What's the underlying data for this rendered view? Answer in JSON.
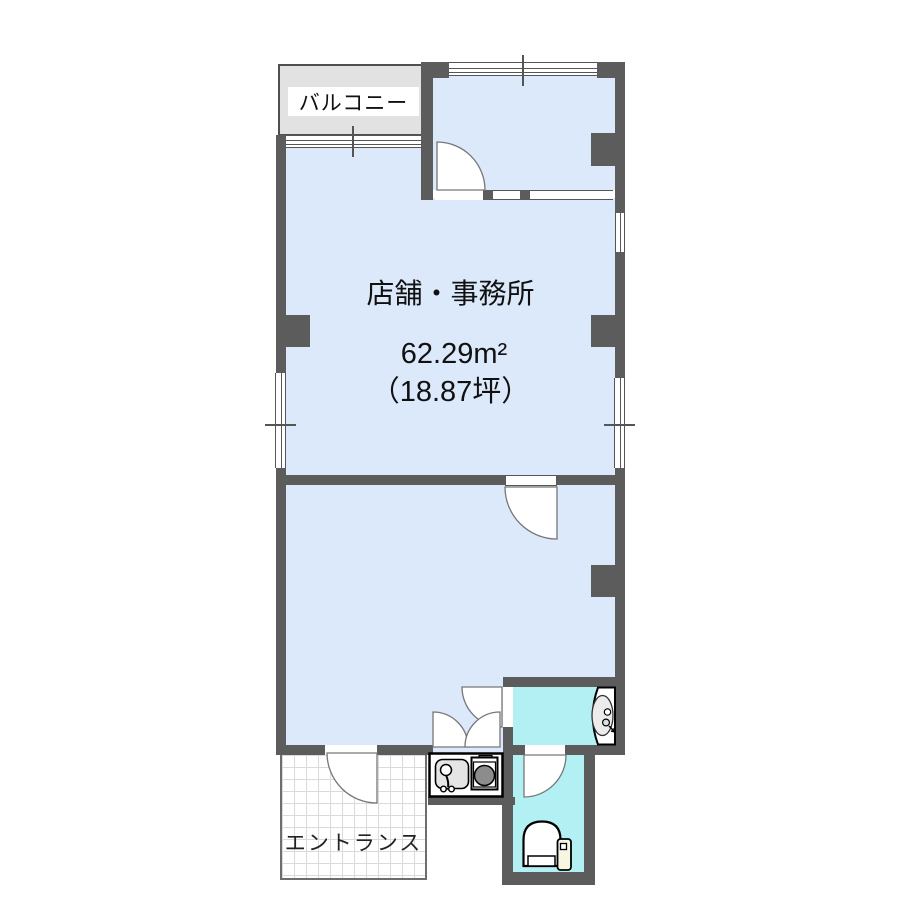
{
  "labels": {
    "balcony": "バルコニー",
    "room_name": "店舗・事務所",
    "area_m2": "62.29m²",
    "area_tsubo": "（18.87坪）",
    "entrance": "エントランス"
  },
  "rooms": [
    {
      "label": "バルコニー",
      "type": "balcony"
    },
    {
      "label": "店舗・事務所",
      "area_m2": "62.29m²",
      "area_tsubo": "（18.87坪）",
      "type": "shop-office"
    },
    {
      "label": "エントランス",
      "type": "entrance"
    }
  ],
  "fixtures": [
    "toilet-icon",
    "washbasin-icon",
    "kitchen-sink-icon",
    "stove-burner-icon",
    "swing-door-icon",
    "double-door-icon",
    "sliding-window-icon"
  ],
  "colors": {
    "bg": "#ffffff",
    "wall": "#5c5c5c",
    "room-fill": "#dce9fb",
    "wet-fill": "#b2f0f4",
    "balcony-fill": "#e2e2e2",
    "outline": "#555555"
  }
}
